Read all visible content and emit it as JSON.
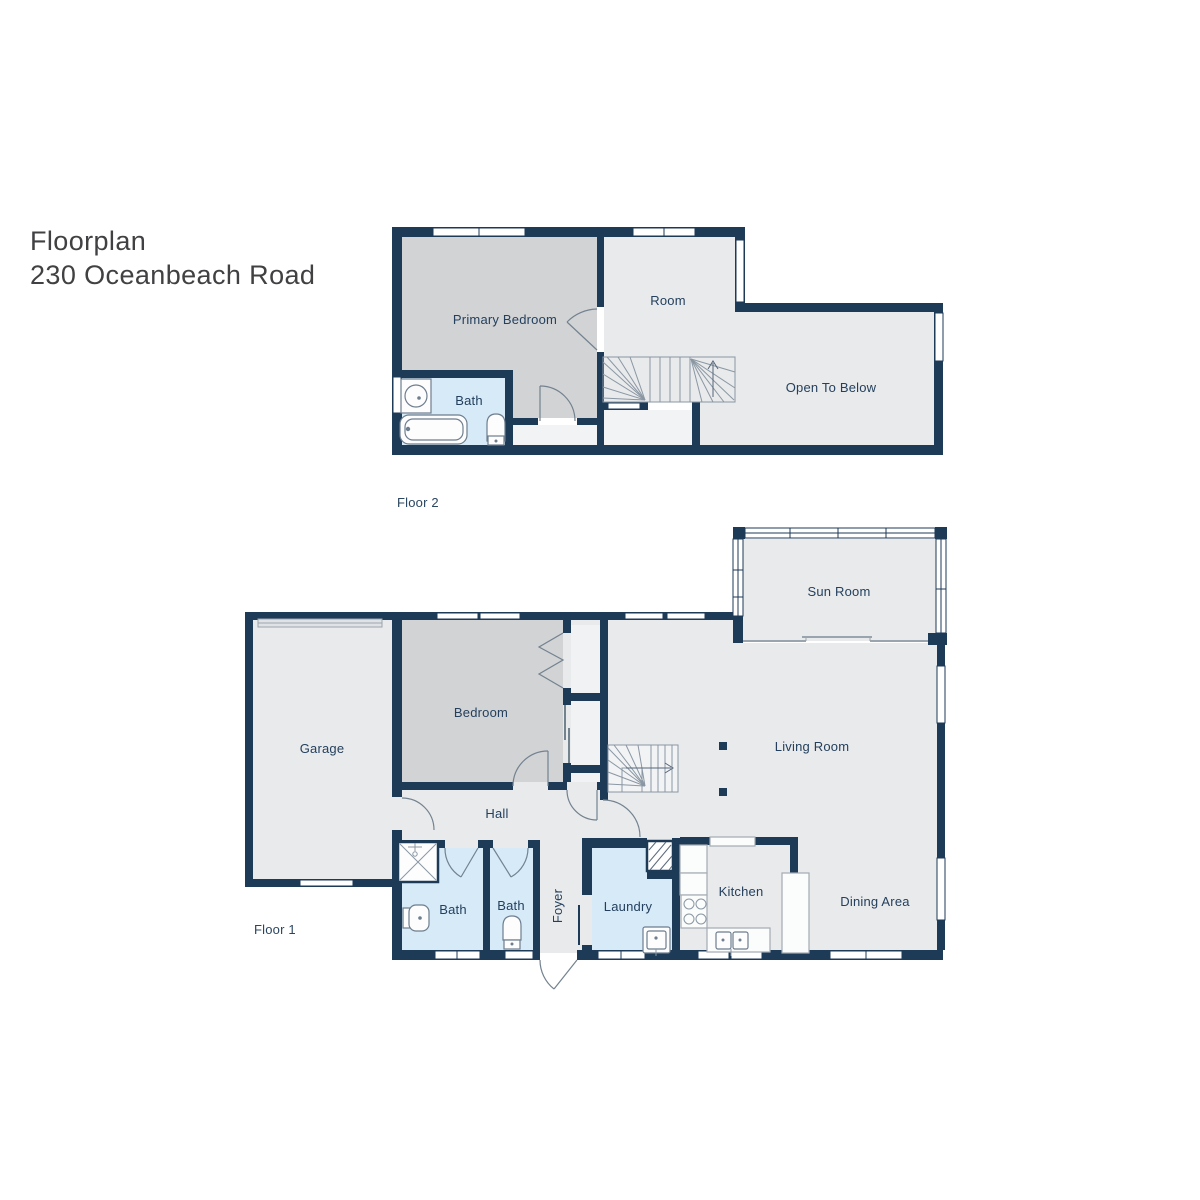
{
  "title": {
    "line1": "Floorplan",
    "line2": "230 Oceanbeach Road"
  },
  "floor2": {
    "label": "Floor 2",
    "rooms": {
      "primary_bedroom": "Primary Bedroom",
      "room": "Room",
      "bath": "Bath",
      "open_to_below": "Open To Below"
    }
  },
  "floor1": {
    "label": "Floor 1",
    "rooms": {
      "garage": "Garage",
      "bedroom": "Bedroom",
      "hall": "Hall",
      "bath1": "Bath",
      "bath2": "Bath",
      "foyer": "Foyer",
      "laundry": "Laundry",
      "kitchen": "Kitchen",
      "dining": "Dining Area",
      "living": "Living Room",
      "sunroom": "Sun Room"
    }
  },
  "colors": {
    "wall": "#1d3a57",
    "room_fill": "#e9eaeb",
    "bedroom_fill": "#d2d3d5",
    "bath_fill": "#d6eaf8",
    "closet_fill": "#f1f2f4",
    "landing_fill": "#f2f3f4",
    "label_text": "#24405e",
    "title_text": "#414042"
  }
}
